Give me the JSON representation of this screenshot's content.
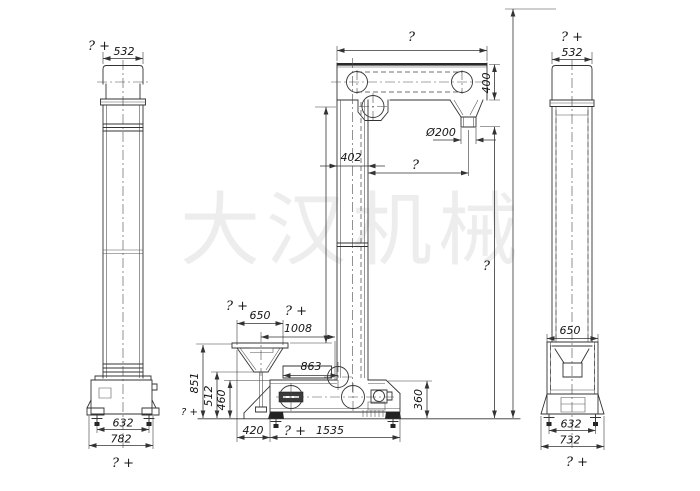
{
  "watermark": "大汉机械",
  "left_view": {
    "top_note": "? +",
    "top_width": "532",
    "bolt_span": "632",
    "base_width": "782",
    "bottom_note": "? +"
  },
  "center_view": {
    "head_width_note": "?",
    "head_height": "400",
    "spout_diameter": "Ø200",
    "column_width": "402",
    "spout_offset_note": "?",
    "discharge_height_note": "?",
    "hopper_note": "? +",
    "hopper_width": "650",
    "offset_note": "? +",
    "hopper_offset": "1008",
    "inlet_length": "863",
    "hopper_height": "851",
    "hopper_lip_height": "512",
    "boot_inlet_height": "460",
    "boot_height": "360",
    "ground_note": "? +",
    "hopper_to_boot": "420",
    "boot_span_note": "? +",
    "boot_span": "1535"
  },
  "right_view": {
    "top_note": "? +",
    "top_width": "532",
    "hopper_width": "650",
    "bolt_span": "632",
    "base_width": "732",
    "bottom_note": "? +"
  }
}
